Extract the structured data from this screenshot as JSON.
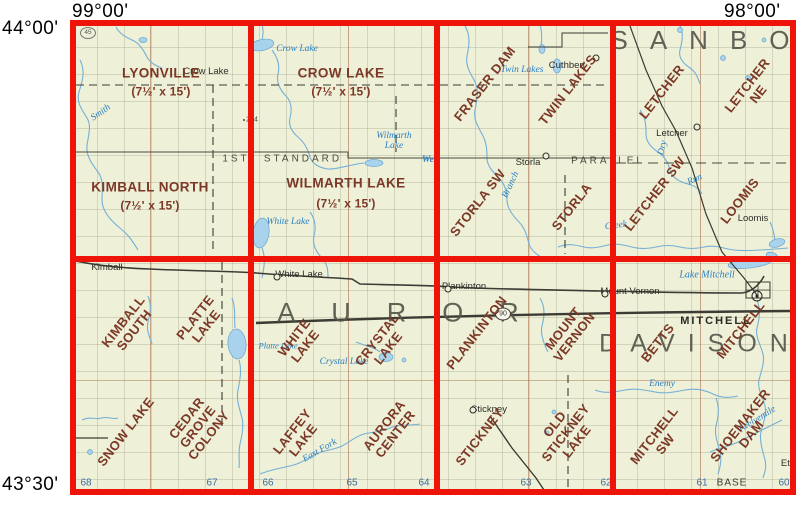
{
  "coords": {
    "top_left": "99°00'",
    "top_right": "98°00'",
    "left_top": "44°00'",
    "left_bottom": "43°30'"
  },
  "counties": {
    "sanborn": "SANBO",
    "aurora": "AUROR",
    "davison": "DAVISON"
  },
  "parallel": {
    "w1": "1ST",
    "w2": "STANDARD",
    "w3": "PARALLEL"
  },
  "quads": {
    "lyonville": "LYONVILLE",
    "lyonville_scale": "(7½' x 15')",
    "kimball_north": "KIMBALL NORTH",
    "kimball_north_scale": "(7½' x 15')",
    "crow_lake": "CROW LAKE",
    "crow_lake_scale": "(7½' x 15')",
    "wilmarth_lake": "WILMARTH LAKE",
    "wilmarth_lake_scale": "(7½' x 15')",
    "fraser_dam": "FRASER DAM",
    "twin_lakes": "TWIN LAKES",
    "storla_sw": "STORLA SW",
    "storla": "STORLA",
    "letcher": "LETCHER",
    "letcher_ne": "LETCHER NE",
    "letcher_sw": "LETCHER SW",
    "loomis": "LOOMIS",
    "kimball_south": "KIMBALL\nSOUTH",
    "platte_lake": "PLATTE\nLAKE",
    "white_lake": "WHITE\nLAKE",
    "crystal_lake": "CRYSTAL\nLAKE",
    "plankinton": "PLANKINTON",
    "mount_vernon": "MOUNT\nVERNON",
    "betts": "BETTS",
    "mitchell": "MITCHELL",
    "snow_lake": "SNOW LAKE",
    "cedar_grove_colony": "CEDAR\nGROVE\nCOLONY",
    "laffey_lake": "LAFFEY\nLAKE",
    "aurora_center": "AURORA\nCENTER",
    "stickney": "STICKNEY",
    "old_stickney_lake": "OLD\nSTICKNEY\nLAKE",
    "mitchell_sw": "MITCHELL\nSW",
    "shoemaker_dam": "SHOEMAKER\nDAM"
  },
  "towns": {
    "crow_lake": "Crow Lake",
    "cuthbert": "Cuthbert",
    "letcher": "Letcher",
    "storla": "Storla",
    "loomis": "Loomis",
    "kimball": "Kimball",
    "white_lake": "White Lake",
    "plankinton": "Plankinton",
    "mount_vernon": "Mount Vernon",
    "mitchell": "MITCHELL",
    "stickney": "Stickney",
    "ethan": "Eth"
  },
  "water": {
    "smith": "Smith",
    "crow_lake": "Crow Lake",
    "twin_lakes": "Twin Lakes",
    "wilmarth_lake": "Wilmarth\nLake",
    "west": "West",
    "white_lake": "White Lake",
    "branch": "Branch",
    "dry": "Dry",
    "run": "Run",
    "creek": "Creek",
    "platte_lake": "Platte Lake",
    "crystal_lake": "Crystal Lake",
    "lake_mitchell": "Lake Mitchell",
    "enemy": "Enemy",
    "east_fork": "East Fork",
    "twelvemile": "Twelvemile"
  },
  "range_numbers": {
    "r68": "68",
    "r67": "67",
    "r66": "66",
    "r65": "65",
    "r64": "64",
    "r63": "63",
    "r62": "62",
    "r61": "61",
    "r60": "60",
    "base": "BASE"
  },
  "markers": {
    "route_90": "90",
    "route_45": "45",
    "spot_204": "204"
  },
  "colors": {
    "grid_red": "#ee1409",
    "quad_brown": "#7c3826",
    "water_blue": "#2b7fc0",
    "map_cream": "#eef0d8",
    "county_gray": "#56564b"
  }
}
